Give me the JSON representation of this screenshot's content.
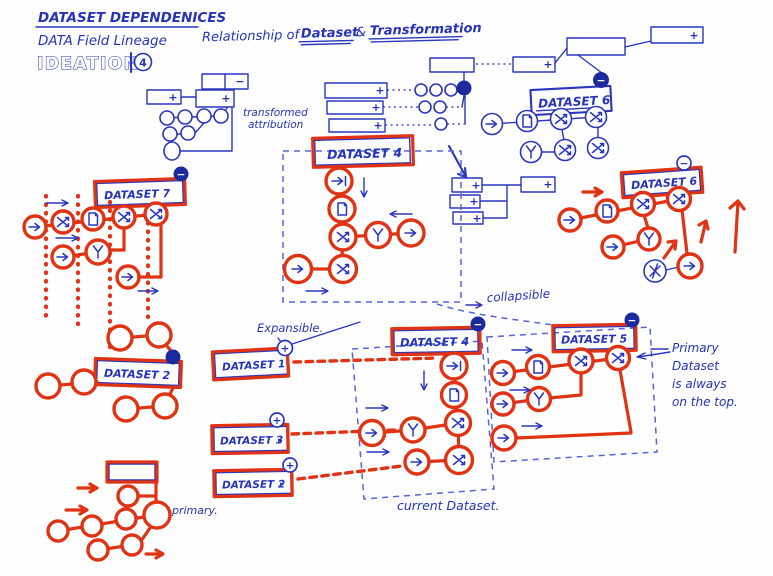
{
  "colors": {
    "blue_ink": "#2734b9",
    "red_ink": "#e03313",
    "dark_badge": "#1c2a9e",
    "paper": "#fefefe"
  },
  "symbols": {
    "plus": "+",
    "minus": "−",
    "triangle": "▸"
  },
  "header": {
    "title": "DATASET DEPENDENICES",
    "subtitle": "DATA Field Lineage",
    "ideation_label": "IDEATION",
    "ideation_number": "4",
    "relationship_prefix": "Relationship of",
    "relationship_dataset": "Dataset",
    "relationship_amp": "&",
    "relationship_transformation": "Transformation"
  },
  "annotations": {
    "transformed_line1": "transformed",
    "transformed_line2": "attribution",
    "collapsible": "collapsible",
    "expansible": "Expansible.",
    "current_dataset": "current Dataset.",
    "primary": "primary.",
    "primary_note_line1": "Primary",
    "primary_note_line2": "Dataset",
    "primary_note_line3": "is always",
    "primary_note_line4": "on the top."
  },
  "datasets": {
    "d7": "DATASET 7",
    "d4_top": "DATASET 4",
    "d6_blue": "DATASET 6",
    "d6_red": "DATASET 6",
    "d2_left": "DATASET 2",
    "d1": "DATASET 1",
    "d3": "DATASET 3",
    "d2_bottom": "DATASET 2",
    "d4_bottom": "DATASET 4",
    "d5": "DATASET 5"
  }
}
